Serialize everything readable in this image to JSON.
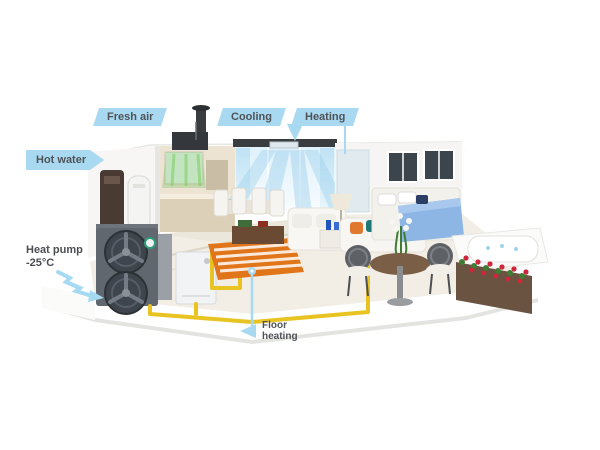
{
  "scene_description": "3D cutaway home illustration of an air source heat pump system with callout labels",
  "labels": {
    "fresh_air": "Fresh air",
    "cooling": "Cooling",
    "heating": "Heating",
    "hot_water": "Hot water",
    "heat_pump": {
      "line1": "Heat pump",
      "line2": "-25°C"
    },
    "floor_heating": {
      "line1": "Floor",
      "line2": "heating"
    }
  },
  "colors": {
    "label_bg": "#a9d9f1",
    "label_text": "#4f5357",
    "pipe_yellow": "#e8c322",
    "floor_coil_orange": "#e0751a",
    "air_green": "#6ebe5a",
    "air_blue": "#8cc9e8",
    "heat_pump_gray": "#60676f",
    "blanket_blue": "#8db6e4",
    "flower_red": "#d0263c"
  }
}
